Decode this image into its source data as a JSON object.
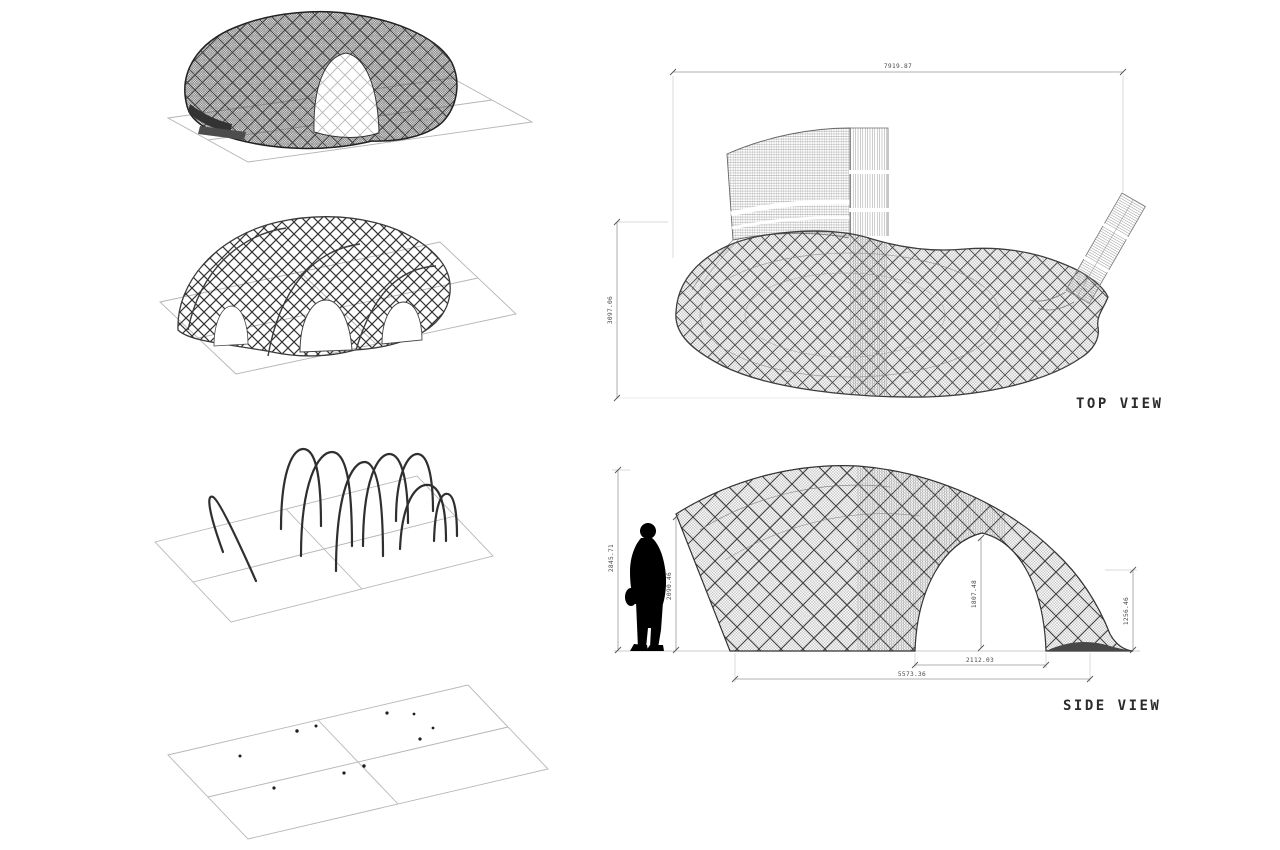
{
  "sheet": {
    "background": "#ffffff",
    "ink_color": "#2b2b2b",
    "dimension_line_color": "#8f8f8f",
    "ground_plane_color": "#b5b5b5",
    "figure_color": "#000000"
  },
  "top_view": {
    "label": "TOP VIEW",
    "dim_width": "7919.87",
    "dim_depth": "3097.06"
  },
  "side_view": {
    "label": "SIDE VIEW",
    "dim_overall_height": "2845.71",
    "dim_left_height": "2090.46",
    "dim_arch_height": "1807.48",
    "dim_tail_height": "1256.46",
    "dim_arch_width": "2112.03",
    "dim_overall_length": "5573.36"
  }
}
